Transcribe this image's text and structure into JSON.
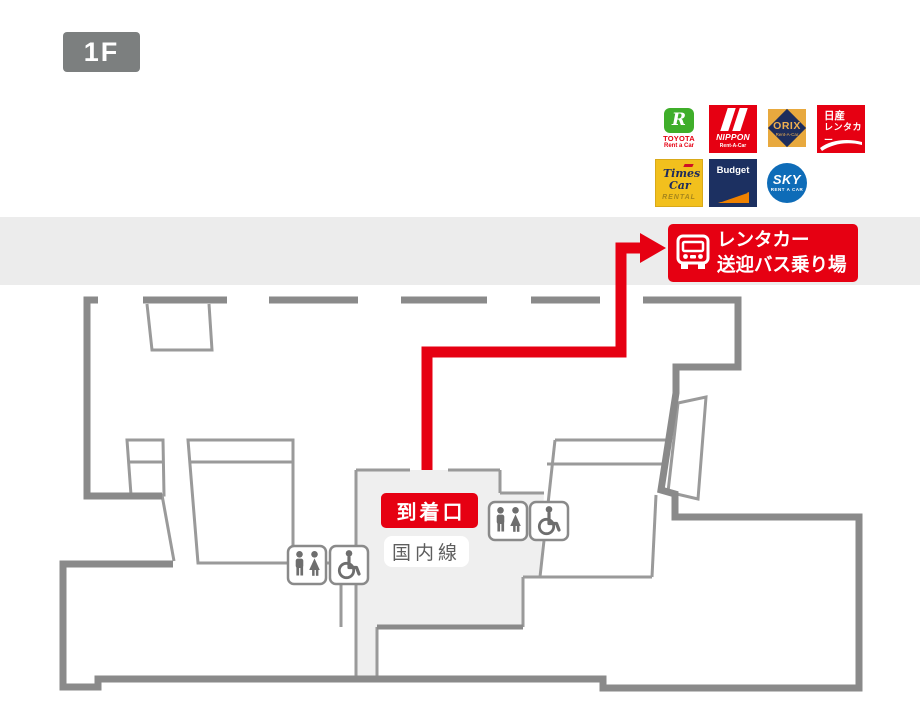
{
  "floor": {
    "label": "1F"
  },
  "destination_sign": {
    "line1": "レンタカー",
    "line2": "送迎バス乗り場"
  },
  "map_labels": {
    "arrival_gate": "到着口",
    "domestic_line": "国内線"
  },
  "rental_logos": {
    "toyota": {
      "letter": "R",
      "brand": "TOYOTA",
      "sub": "Rent a Car"
    },
    "nippon": {
      "brand": "NIPPON",
      "sub": "Rent-A-Car"
    },
    "orix": {
      "brand": "ORIX",
      "sub": "Rent-A-Car"
    },
    "nissan": {
      "line1": "日産",
      "line2": "レンタカー"
    },
    "times": {
      "line1": "Times",
      "line2": "Car",
      "sub": "RENTAL"
    },
    "budget": {
      "brand": "Budget"
    },
    "sky": {
      "brand": "SKY",
      "sub": "RENT A CAR"
    }
  },
  "icons": {
    "bus": "bus-icon",
    "restroom": "restroom-icon",
    "wheelchair": "wheelchair-icon"
  },
  "colors": {
    "accent_red": "#e60012",
    "wall_gray": "#8a8a8a",
    "thin_wall_gray": "#9a9a9a",
    "band_gray": "#ececec",
    "area_gray": "#efefef",
    "badge_gray": "#7c7f7f"
  }
}
